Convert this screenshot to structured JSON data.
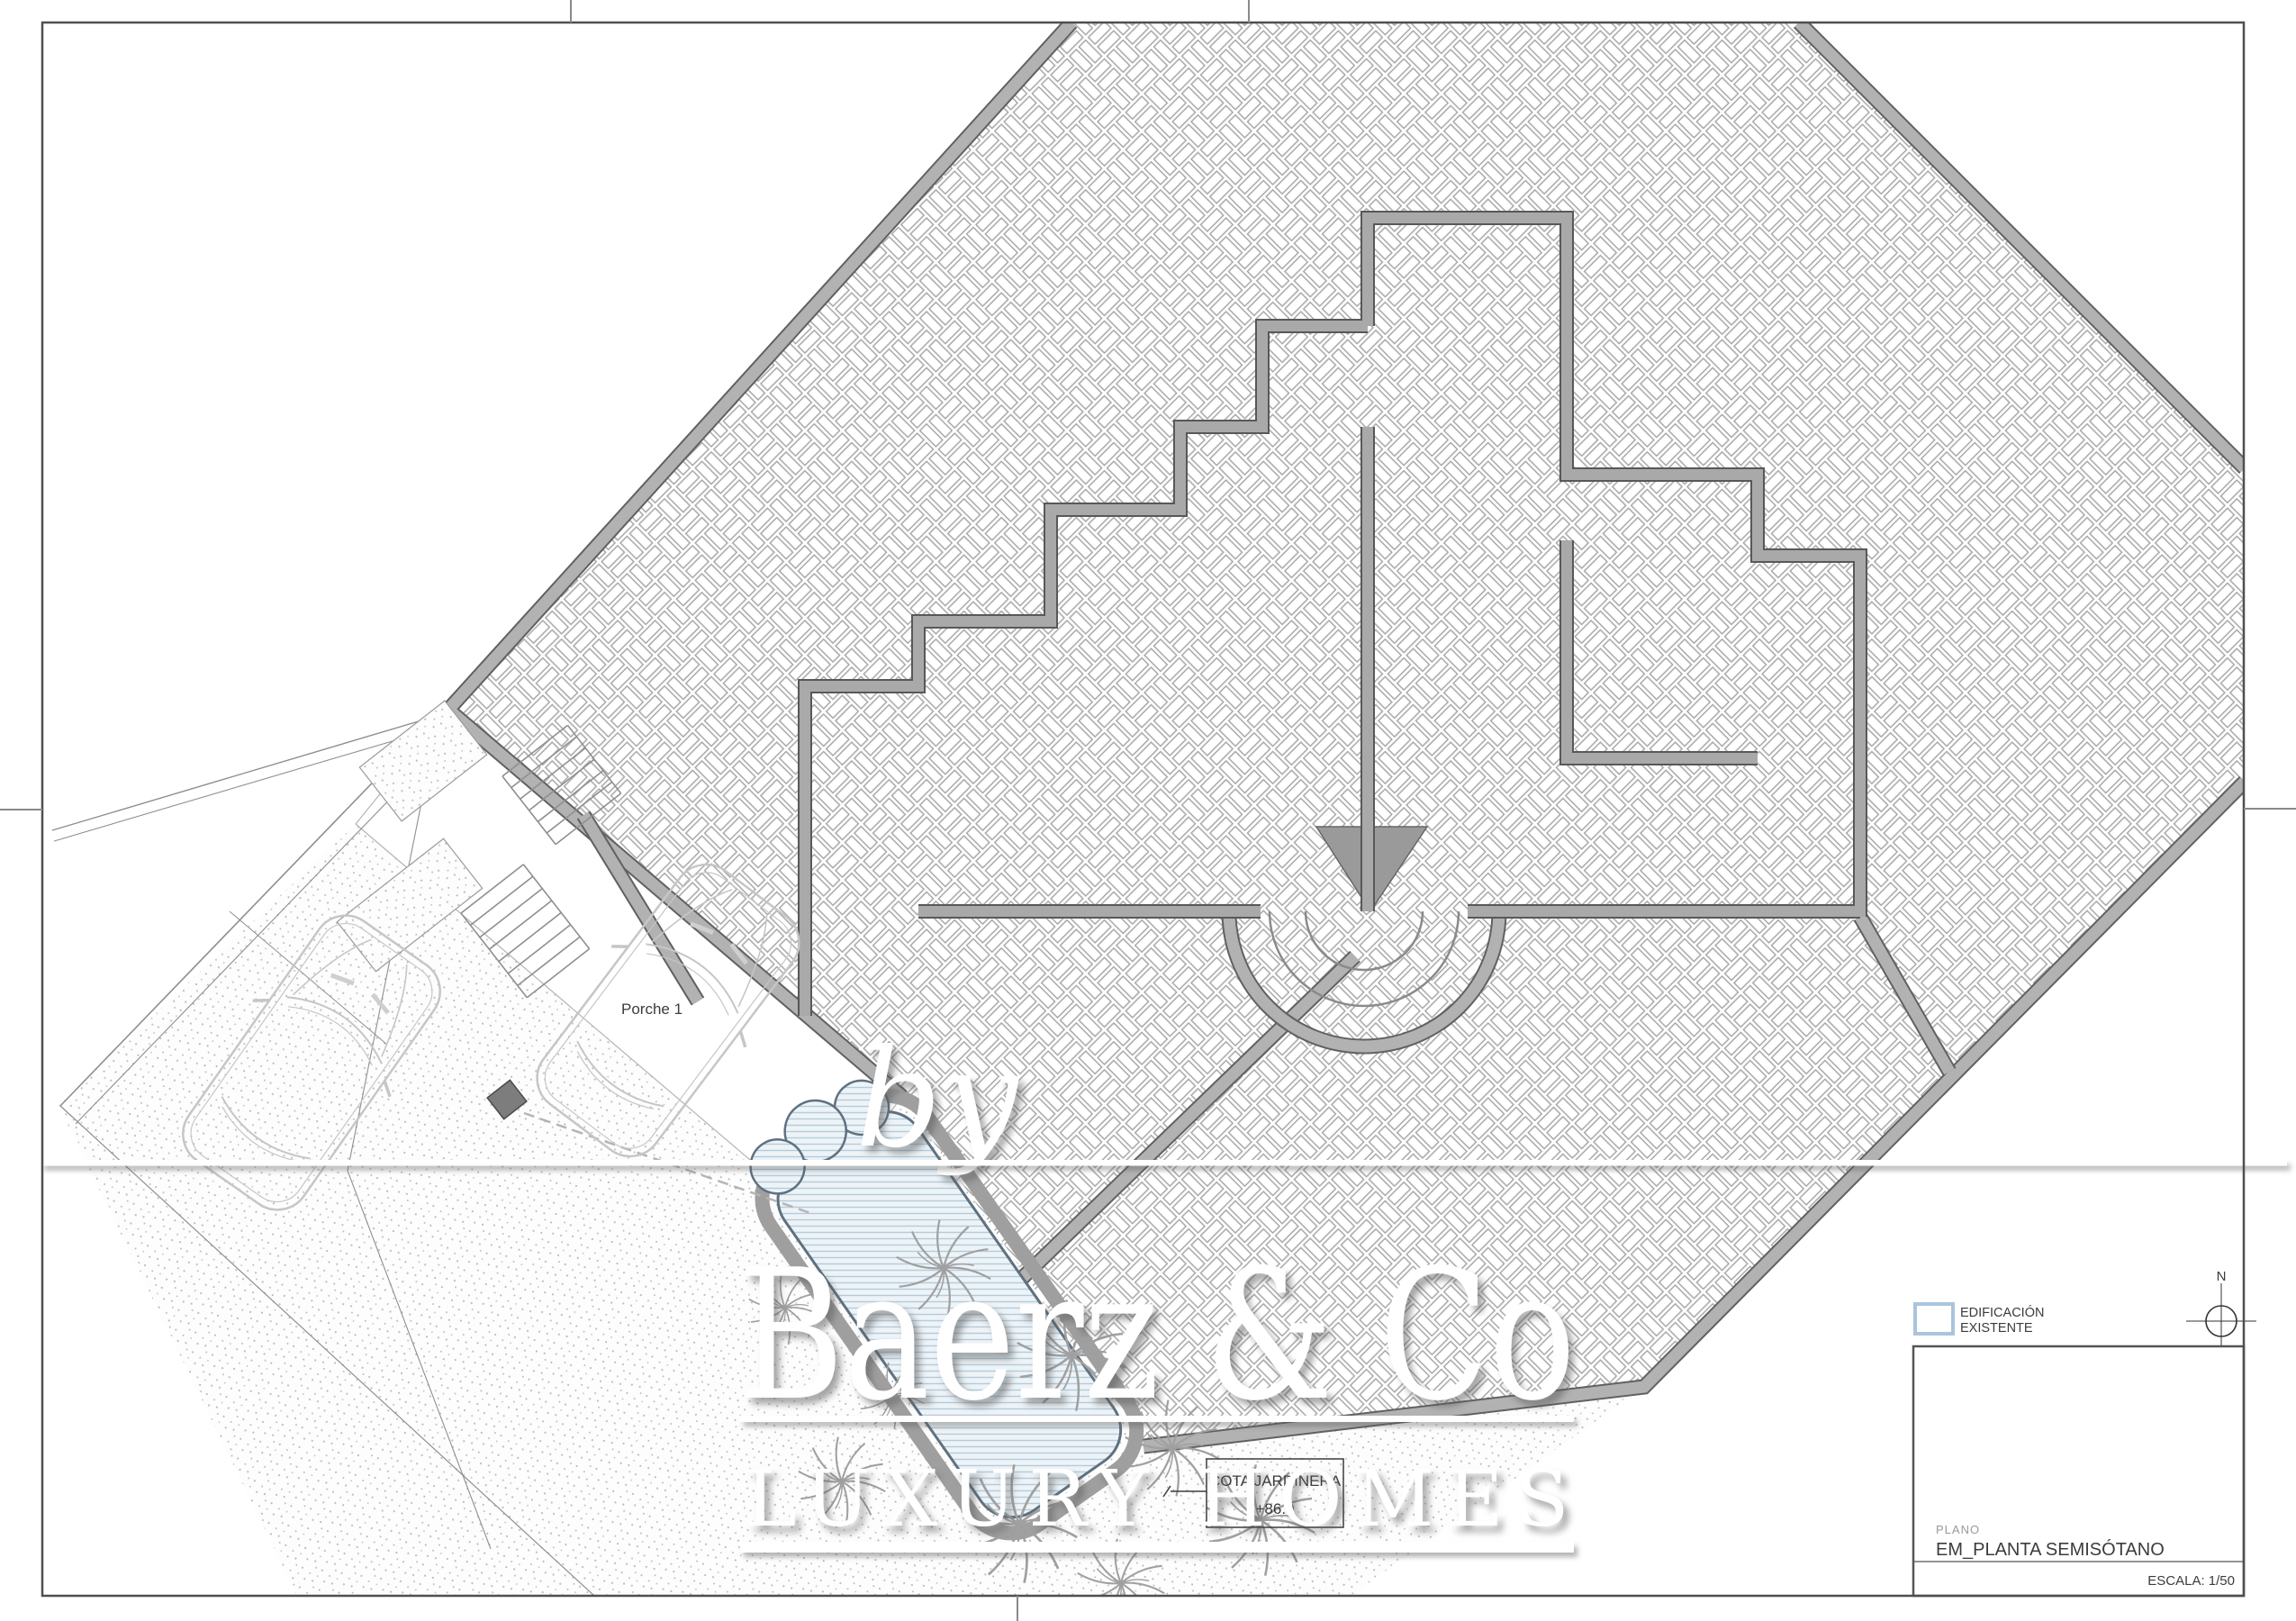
{
  "watermark": {
    "by": "by",
    "brand": "Baerz & Co",
    "tagline": "LUXURY HOMES"
  },
  "plan_labels": {
    "porch": "Porche 1",
    "cota_line1": "COTA JARDINERA",
    "cota_line2": "+86.0"
  },
  "legend": {
    "existing_line1": "EDIFICACIÓN",
    "existing_line2": "EXISTENTE"
  },
  "north": {
    "label": "N"
  },
  "title_block": {
    "field_label": "PLANO",
    "drawing_name": "EM_PLANTA SEMISÓTANO",
    "scale_label": "ESCALA: 1/50"
  },
  "colors": {
    "legend_accent": "#a9c4de",
    "pool_stripe": "#b3ccdb",
    "pool_fill": "#edf3f7",
    "wall_gray": "#a9a9a9",
    "boundary_gray": "#b2b2b2",
    "hatch_line": "#a6a6a6",
    "border_dark": "#4f4f4f"
  }
}
